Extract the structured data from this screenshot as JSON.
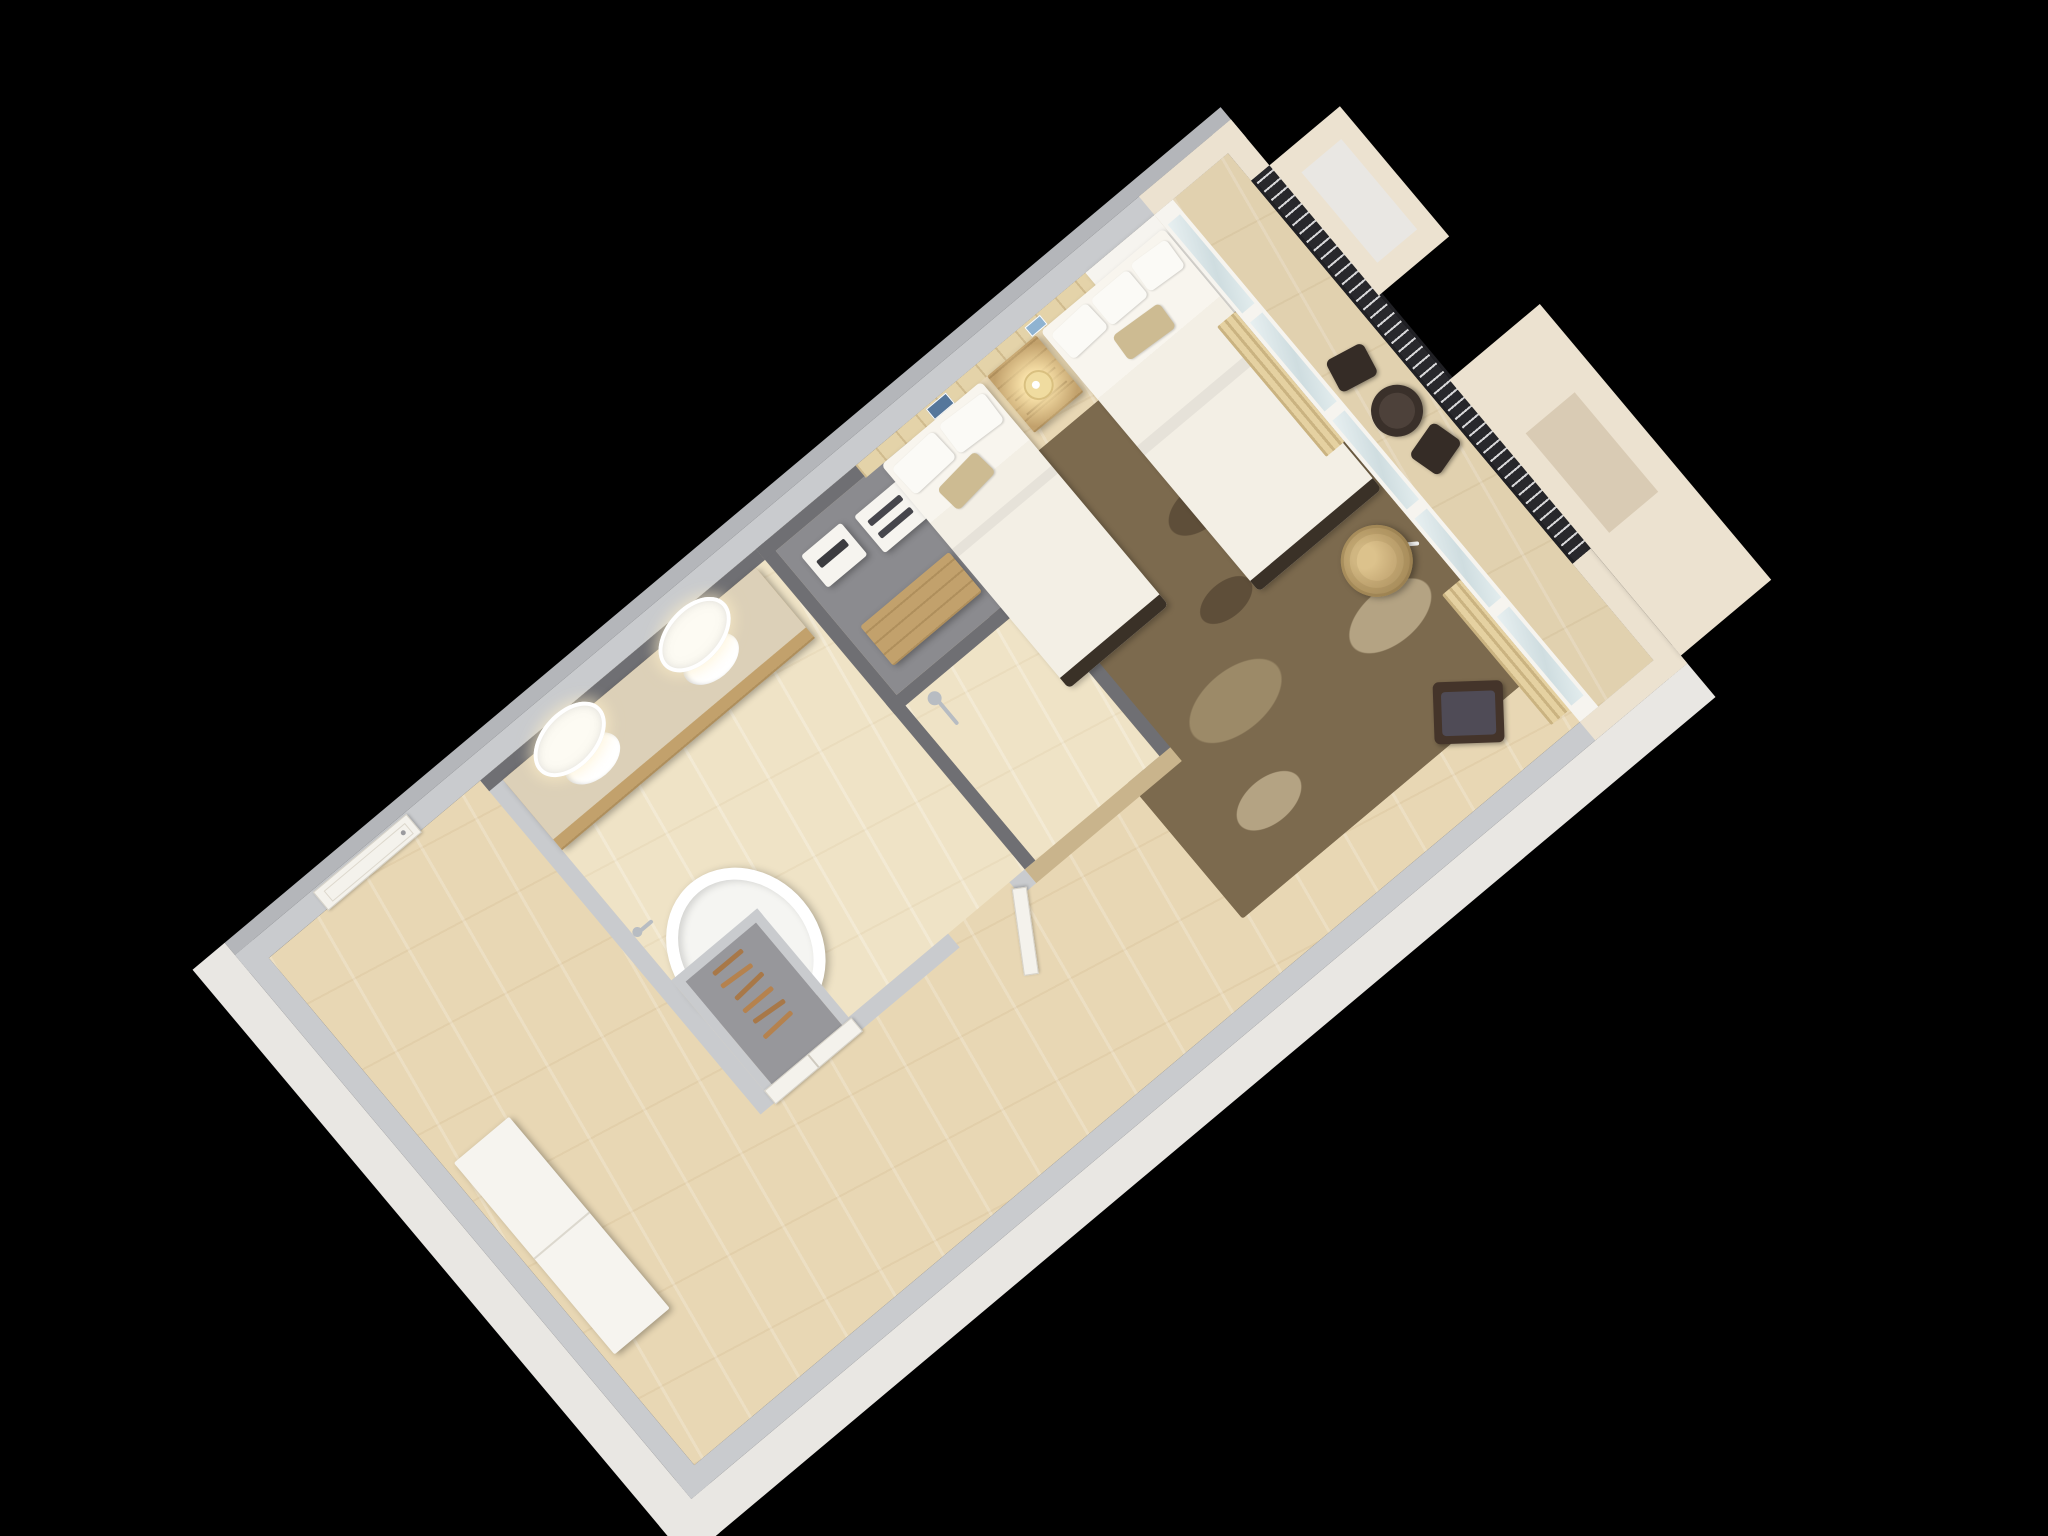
{
  "scene": {
    "description": "isometric-3d-cutaway-floorplan-of-hotel-guest-room",
    "view": "top-down-rotated",
    "rotation_deg": -40,
    "background": "#000000"
  },
  "palette": {
    "bg": "#000000",
    "wall-top": "#c9cbce",
    "wall-top-dark": "#b4b6ba",
    "wall-outer": "#e9e7e3",
    "wall-cream": "#ece2d0",
    "wall-dark": "#6f6f73",
    "wall-mid": "#97979b",
    "floor-marble": "#e8d7b4",
    "floor-marble-light": "#efe3c6",
    "floor-closet": "#8b8b8f",
    "wood-panel": "#e4d3a9",
    "wood": "#c2a16c",
    "counter": "#dcd0b8",
    "rug1": "#7c6a4e",
    "rug2": "#5e4e39",
    "rug3": "#9c8a68",
    "rug4": "#b4a383",
    "linen": "#f3efe5",
    "pillow": "#fbfaf6",
    "accent-pillow": "#cdbb92",
    "bed-base": "#3a3127",
    "lamp-glow": "#ffe9b0",
    "lamp-shade": "#f0dca0",
    "rattan": "#c9ad79",
    "rattan-dark": "#a98f5e",
    "chair-dark": "#44342a",
    "cushion": "#4f4b56",
    "railing": "#28282c",
    "railing-slot": "#d8d8da",
    "glass": "#cfdde0",
    "frame-white": "#f6f4ef",
    "curtain": "#e5d1a1",
    "chrome": "#b7bcc2",
    "door-white": "#f4f2ec",
    "gold-wall": "#c9b48c",
    "art-blue": "#56779b",
    "art-lightblue": "#8fb3d1"
  },
  "rooms": [
    {
      "name": "entry-hall",
      "items": [
        "entry-door",
        "shoe-cabinet"
      ]
    },
    {
      "name": "bathroom",
      "items": [
        "double-vanity",
        "sink-left",
        "sink-right",
        "oval-mirror-left",
        "oval-mirror-right",
        "freestanding-bathtub",
        "tub-faucet",
        "bathroom-door"
      ]
    },
    {
      "name": "wardrobe-closet",
      "items": [
        "clothes-hangers",
        "closet-double-doors"
      ]
    },
    {
      "name": "storage-closet",
      "items": [
        "safe-box",
        "shelf-unit",
        "luggage-bench"
      ]
    },
    {
      "name": "shower-room",
      "items": [
        "shower-fixture",
        "gold-feature-wall"
      ]
    },
    {
      "name": "hallway",
      "items": []
    },
    {
      "name": "bedroom",
      "items": [
        "twin-bed",
        "double-bed",
        "nightstand",
        "table-lamp",
        "wall-art-left",
        "wall-art-right",
        "area-rug",
        "lounge-chair",
        "rattan-floor-lamp",
        "curtain-left",
        "curtain-right",
        "wood-headboard-wall",
        "white-column",
        "sliding-glass-doors"
      ]
    },
    {
      "name": "balcony",
      "items": [
        "balcony-table",
        "balcony-chair-left",
        "balcony-chair-right",
        "balcony-railing",
        "neighbor-parapet-north",
        "neighbor-parapet-south"
      ]
    }
  ]
}
